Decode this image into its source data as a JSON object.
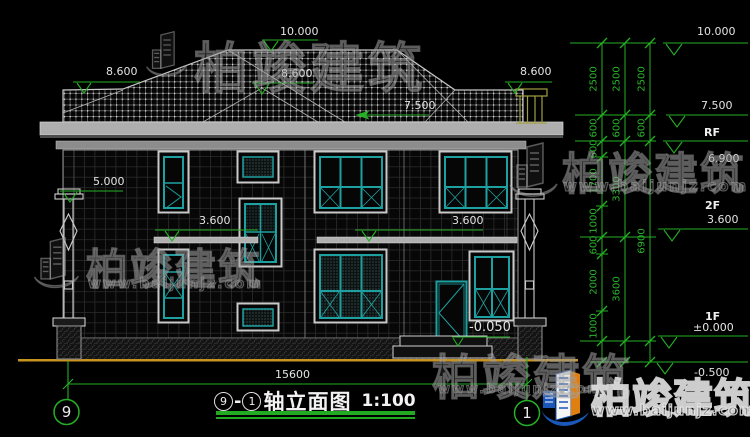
{
  "watermark": {
    "brand": "柏竣建筑",
    "url": "www.baijunjz.com"
  },
  "title": {
    "axis_left": "9",
    "dash": "-",
    "axis_right": "1",
    "name": "轴立面图",
    "scale": "1:100"
  },
  "axes": {
    "left": "9",
    "right": "1"
  },
  "dims": {
    "ridge": "10.000",
    "eave_left": "8.600",
    "eave_mid": "8.600",
    "eave_right": "8.600",
    "roof_low": "7.500",
    "left_wall": "5.000",
    "floor2_left": "3.600",
    "floor2_right": "3.600",
    "entry": "-0.050",
    "total_width": "15600"
  },
  "levels": {
    "top": "10.000",
    "roof": "7.500",
    "rf": "RF",
    "parapet": "6.900",
    "f2": "2F",
    "f2_elev": "3.600",
    "f1": "1F",
    "f1_elev": "±0.000",
    "base": "-0.500"
  },
  "chains": {
    "inner": [
      "2500",
      "600",
      "600",
      "1700",
      "1000",
      "600",
      "2000",
      "1000"
    ],
    "middle": [
      "2500",
      "600",
      "3300",
      "3600"
    ],
    "outer": [
      "2500",
      "600",
      "6900"
    ]
  }
}
